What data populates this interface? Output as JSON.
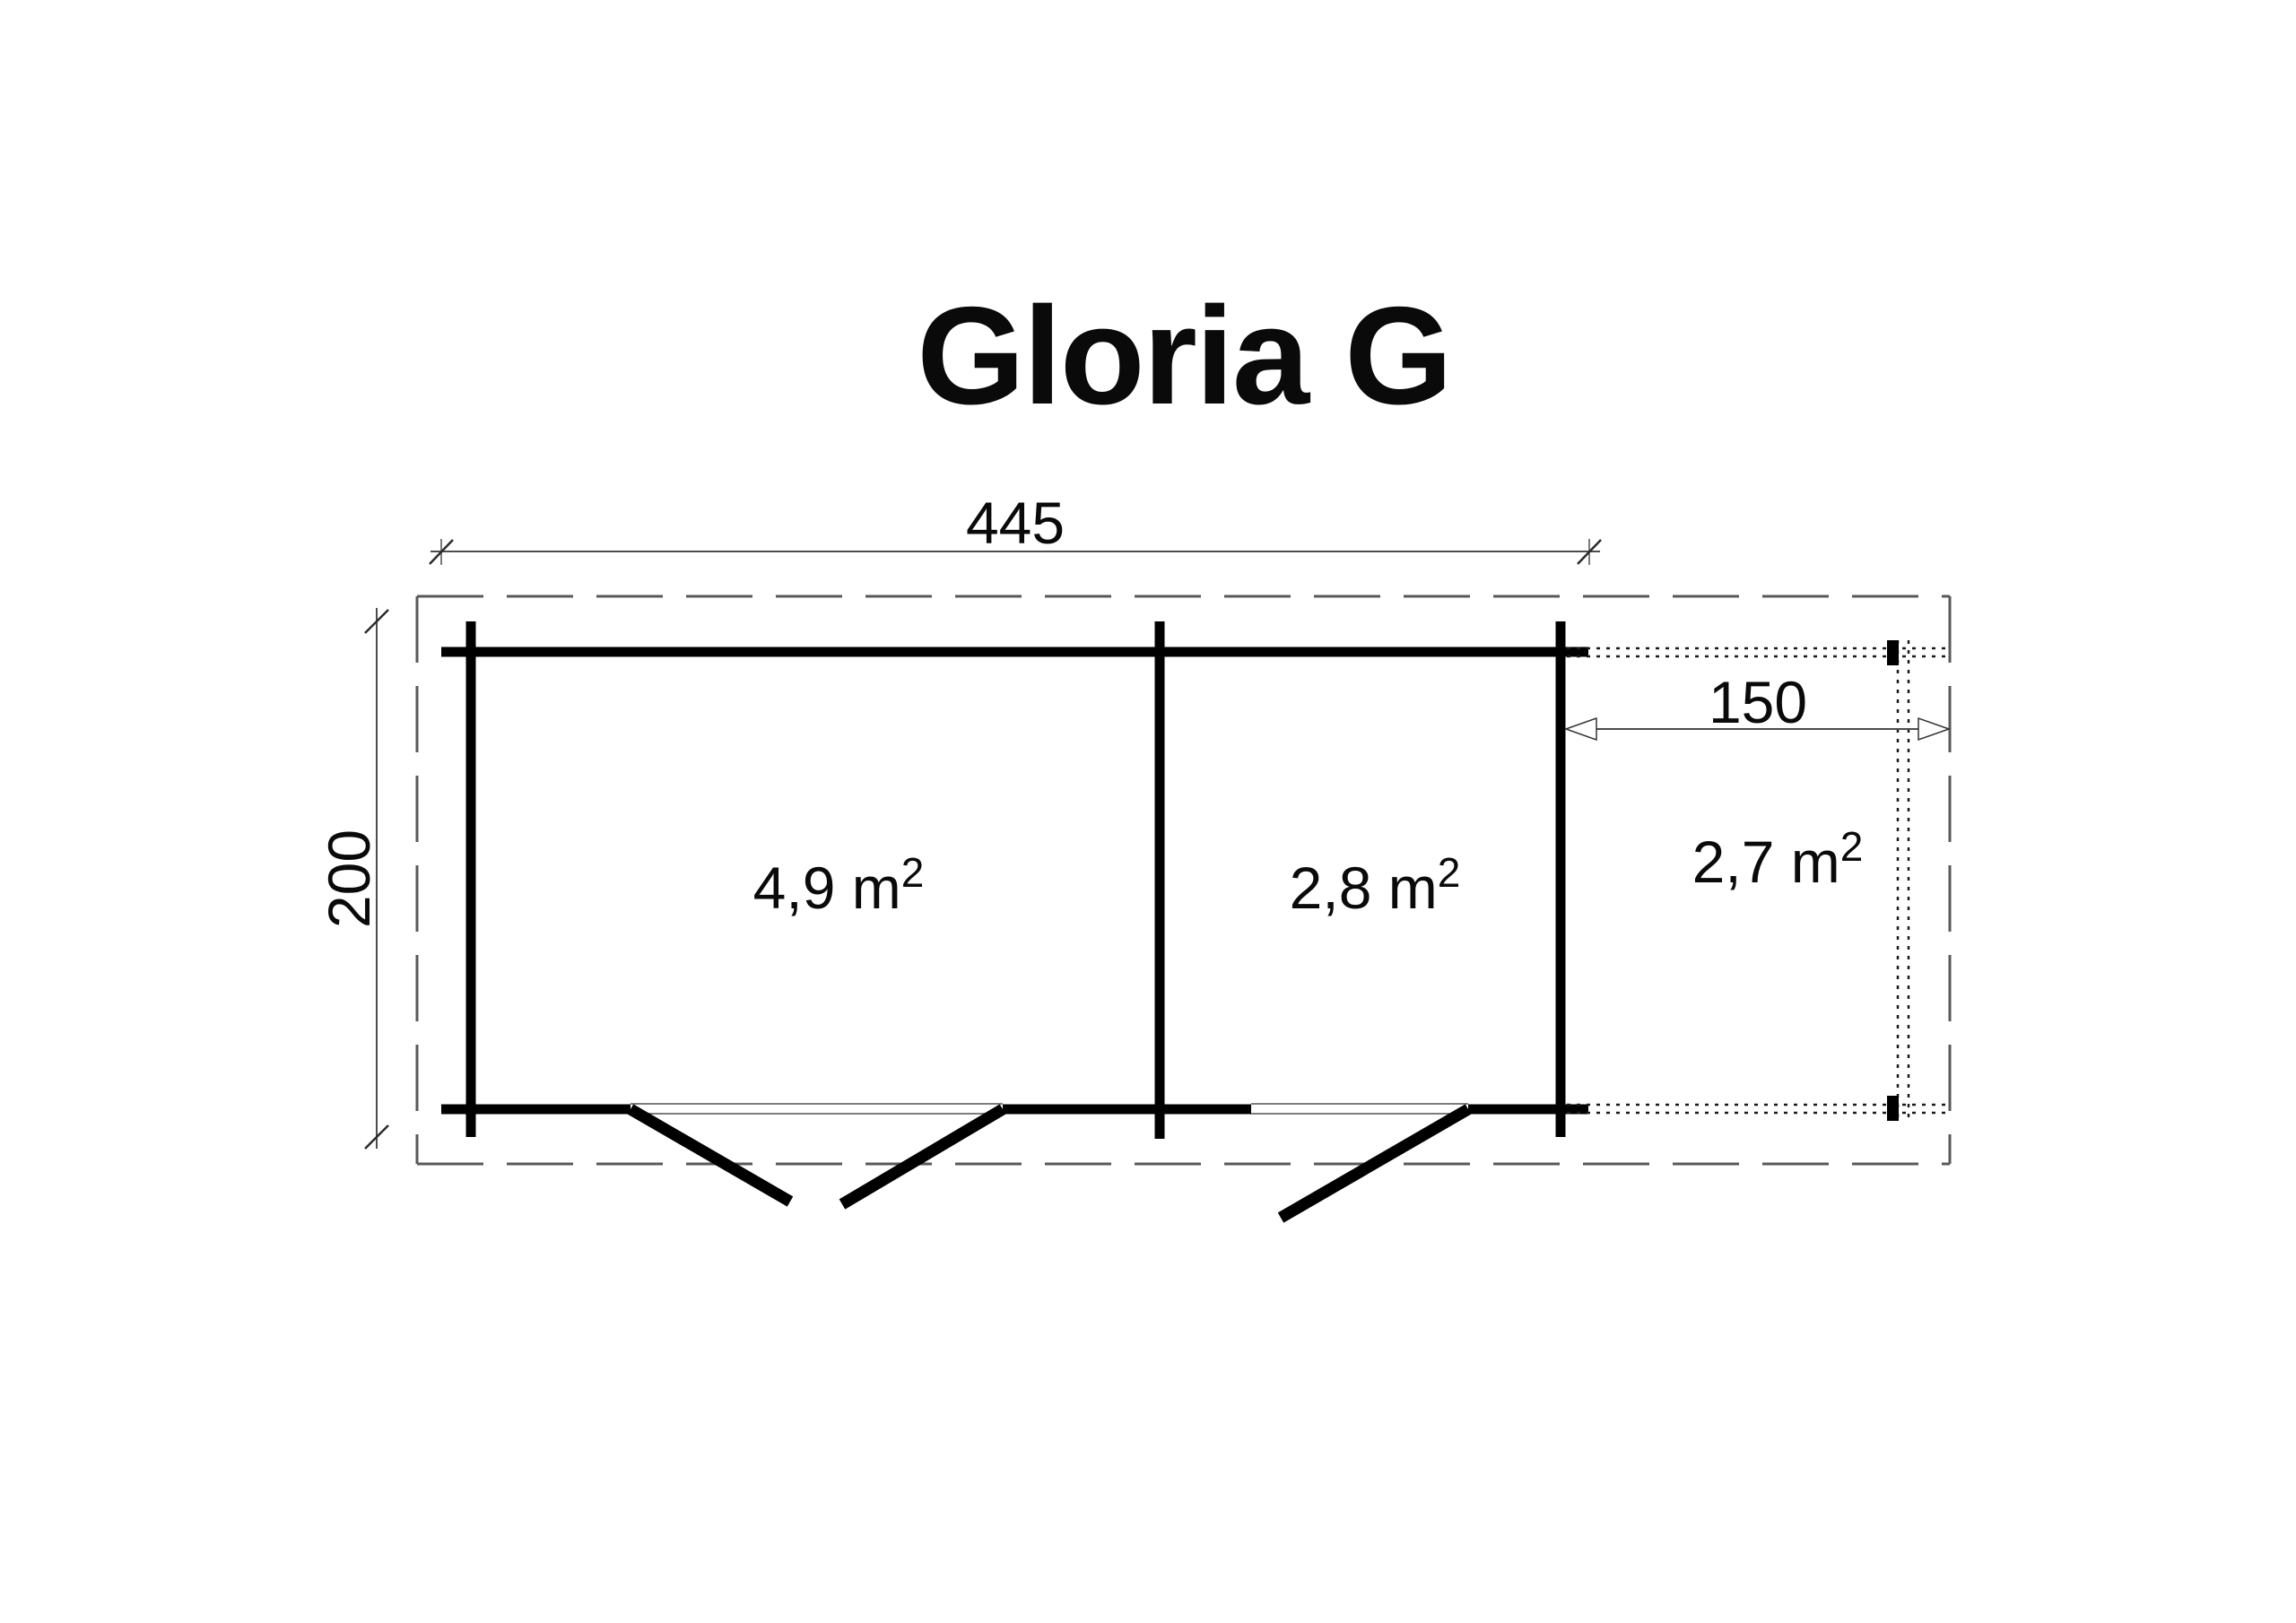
{
  "title": "Gloria G",
  "dimensions": {
    "overall_width": "445",
    "overall_depth": "200",
    "terrace_depth": "150"
  },
  "rooms": [
    {
      "name": "main-room",
      "label": "4,9 m",
      "sup": "2"
    },
    {
      "name": "side-room",
      "label": "2,8 m",
      "sup": "2"
    },
    {
      "name": "terrace-area",
      "label": "2,7 m",
      "sup": "2"
    }
  ],
  "colors": {
    "wall": "#000000",
    "dimension_line": "#4d4d4d",
    "roof_dash": "#595959",
    "terrace_dot": "#1a1a1a",
    "threshold": "#7d7d7d",
    "background": "#ffffff"
  }
}
